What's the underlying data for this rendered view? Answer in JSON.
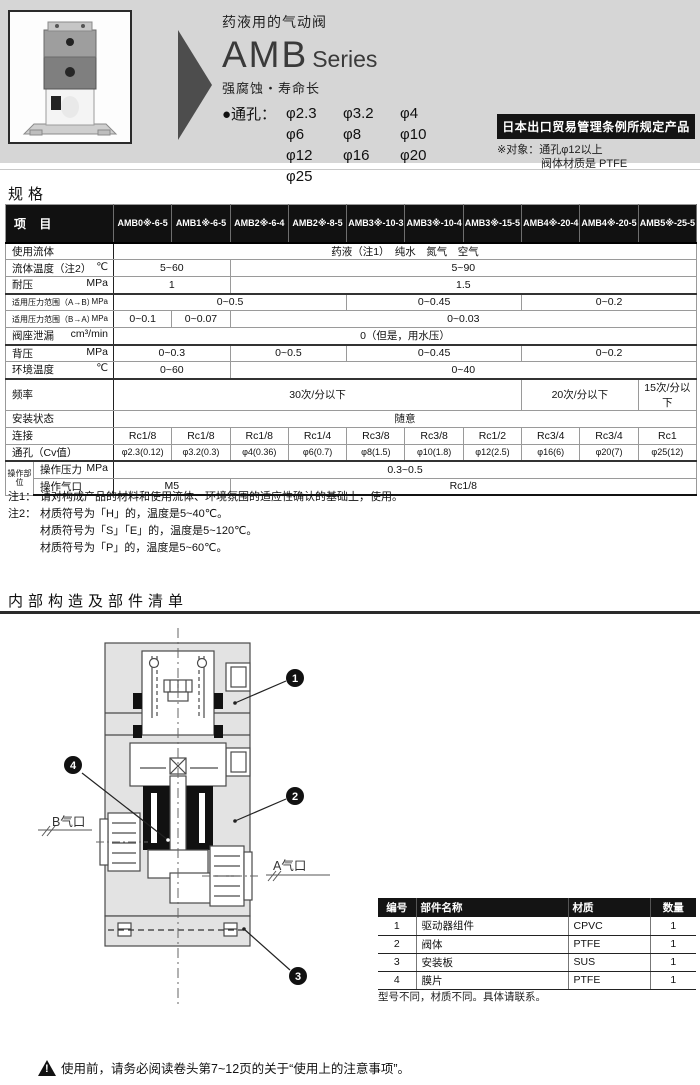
{
  "colors": {
    "band_bg": "#d6d6d6",
    "badge_bg": "#141414",
    "table_header_bg": "#111111",
    "rule_color": "#2a2a2a"
  },
  "header": {
    "subtitle": "药液用的气动阀",
    "series_name": "AMB",
    "series_suffix": "Series",
    "tagline": "强腐蚀・寿命长",
    "bore_label": "●通孔：",
    "bore_rows": [
      [
        "φ2.3",
        "φ3.2",
        "φ4"
      ],
      [
        "φ6",
        "φ8",
        "φ10"
      ],
      [
        "φ12",
        "φ16",
        "φ20"
      ],
      [
        "φ25"
      ]
    ],
    "badge": "日本出口贸易管理条例所规定产品",
    "badge_note_label": "※对象：",
    "badge_note_line1": "通孔φ12以上",
    "badge_note_line2": "阀体材质是 PTFE"
  },
  "spec": {
    "section_title": "规格",
    "item_header": "项 目",
    "models": [
      "AMB0※-6-5",
      "AMB1※-6-5",
      "AMB2※-6-4",
      "AMB2※-8-5",
      "AMB3※-10-3",
      "AMB3※-10-4",
      "AMB3※-15-5",
      "AMB4※-20-4",
      "AMB4※-20-5",
      "AMB5※-25-5"
    ],
    "rows": [
      {
        "label": "使用流体",
        "unit": "",
        "cells": [
          [
            "药液（注1）　纯水　氮气　空气",
            10
          ]
        ]
      },
      {
        "label": "流体温度（注2）",
        "unit": "℃",
        "cells": [
          [
            "5~60",
            2
          ],
          [
            "5~90",
            8
          ]
        ]
      },
      {
        "label": "耐压",
        "unit": "MPa",
        "thick": true,
        "cells": [
          [
            "1",
            2
          ],
          [
            "1.5",
            8
          ]
        ]
      },
      {
        "label": "适用压力范围（A→B）",
        "unit": "MPa",
        "small": true,
        "cells": [
          [
            "0~0.5",
            4
          ],
          [
            "0~0.45",
            3
          ],
          [
            "0~0.2",
            3
          ]
        ]
      },
      {
        "label": "适用压力范围（B→A）",
        "unit": "MPa",
        "small": true,
        "cells": [
          [
            "0~0.1",
            1
          ],
          [
            "0~0.07",
            1
          ],
          [
            "0~0.03",
            8
          ]
        ]
      },
      {
        "label": "阀座泄漏",
        "unit": "cm³/min",
        "thick": true,
        "cells": [
          [
            "0（但是，用水压）",
            10
          ]
        ]
      },
      {
        "label": "背压",
        "unit": "MPa",
        "cells": [
          [
            "0~0.3",
            2
          ],
          [
            "0~0.5",
            2
          ],
          [
            "0~0.45",
            3
          ],
          [
            "0~0.2",
            3
          ]
        ]
      },
      {
        "label": "环境温度",
        "unit": "℃",
        "thick": true,
        "cells": [
          [
            "0~60",
            2
          ],
          [
            "0~40",
            8
          ]
        ]
      },
      {
        "label": "频率",
        "unit": "",
        "cells": [
          [
            "30次/分以下",
            7
          ],
          [
            "20次/分以下",
            2
          ],
          [
            "15次/分以下",
            1
          ]
        ]
      },
      {
        "label": "安装状态",
        "unit": "",
        "cells": [
          [
            "随意",
            10
          ]
        ]
      },
      {
        "label": "连接",
        "unit": "",
        "cells": [
          [
            "Rc1/8",
            1
          ],
          [
            "Rc1/8",
            1
          ],
          [
            "Rc1/8",
            1
          ],
          [
            "Rc1/4",
            1
          ],
          [
            "Rc3/8",
            1
          ],
          [
            "Rc3/8",
            1
          ],
          [
            "Rc1/2",
            1
          ],
          [
            "Rc3/4",
            1
          ],
          [
            "Rc3/4",
            1
          ],
          [
            "Rc1",
            1
          ]
        ]
      },
      {
        "label": "通孔（Cv值）",
        "unit": "",
        "thick": true,
        "small_vals": true,
        "cells": [
          [
            "φ2.3(0.12)",
            1
          ],
          [
            "φ3.2(0.3)",
            1
          ],
          [
            "φ4(0.36)",
            1
          ],
          [
            "φ6(0.7)",
            1
          ],
          [
            "φ8(1.5)",
            1
          ],
          [
            "φ10(1.8)",
            1
          ],
          [
            "φ12(2.5)",
            1
          ],
          [
            "φ16(6)",
            1
          ],
          [
            "φ20(7)",
            1
          ],
          [
            "φ25(12)",
            1
          ]
        ]
      }
    ],
    "op_group": {
      "label": "操作部位",
      "rows": [
        {
          "label": "操作压力",
          "unit": "MPa",
          "cells": [
            [
              "0.3~0.5",
              10
            ]
          ]
        },
        {
          "label": "操作气口",
          "unit": "",
          "cells": [
            [
              "M5",
              2
            ],
            [
              "Rc1/8",
              8
            ]
          ]
        }
      ]
    },
    "notes": [
      {
        "label": "注1：",
        "text": "请对构成产品的材料和使用流体、环境氛围的适应性确认的基础上，使用。"
      },
      {
        "label": "注2：",
        "text": "材质符号为「H」的，温度是5~40℃。"
      },
      {
        "label": "",
        "text": "材质符号为「S」「E」的，温度是5~120℃。"
      },
      {
        "label": "",
        "text": "材质符号为「P」的，温度是5~60℃。"
      }
    ]
  },
  "structure": {
    "section_title": "内部构造及部件清单",
    "diagram": {
      "port_b": "B气口",
      "port_a": "A气口",
      "callouts": [
        "1",
        "2",
        "3",
        "4"
      ]
    },
    "parts_table": {
      "headers": [
        "编号",
        "部件名称",
        "材质",
        "数量"
      ],
      "rows": [
        [
          "1",
          "驱动器组件",
          "CPVC",
          "1"
        ],
        [
          "2",
          "阀体",
          "PTFE",
          "1"
        ],
        [
          "3",
          "安装板",
          "SUS",
          "1"
        ],
        [
          "4",
          "膜片",
          "PTFE",
          "1"
        ]
      ],
      "note": "型号不同，材质不同。具体请联系。"
    }
  },
  "footer": {
    "warning": "使用前，请务必阅读卷头第7~12页的关于“使用上的注意事项”。"
  }
}
